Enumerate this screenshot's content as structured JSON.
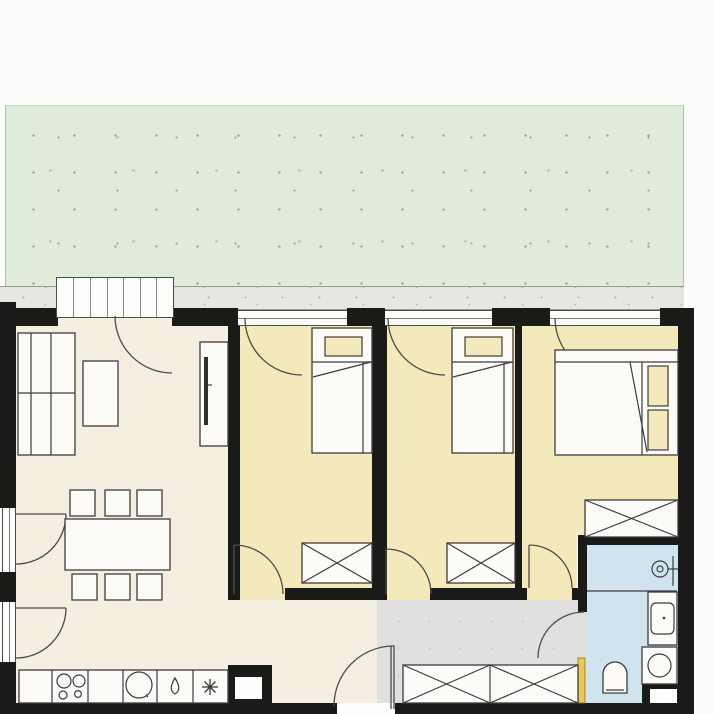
{
  "palette": {
    "outside": "#fcfcfb",
    "terrace": "#dfecda",
    "terrace_dot": "#8fa98a",
    "walk_strip": "#e7e7e2",
    "strip_dot": "#b5b5ad",
    "wall": "#1a1a18",
    "living": "#f5efe2",
    "bedroom": "#f3e9bb",
    "hall": "#e0e0de",
    "hall_dot": "#c6c6c2",
    "bathroom": "#cfe4ef",
    "furniture_fill": "#fcfbf7",
    "furniture_stroke": "#3c3c3c",
    "window_frame": "#4a4a46",
    "door_leaf": "#e8c952",
    "tv": "#2f2f2f"
  },
  "rooms": [
    {
      "name": "terrace-garden",
      "fill": "terrace"
    },
    {
      "name": "terrace-walkway",
      "fill": "walk_strip"
    },
    {
      "name": "living-dining-kitchen",
      "fill": "living"
    },
    {
      "name": "bedroom-1",
      "fill": "bedroom"
    },
    {
      "name": "bedroom-2",
      "fill": "bedroom"
    },
    {
      "name": "bedroom-3",
      "fill": "bedroom"
    },
    {
      "name": "entrance-hall",
      "fill": "hall"
    },
    {
      "name": "bathroom",
      "fill": "bathroom"
    }
  ],
  "furniture": {
    "living": [
      "corner-sofa",
      "coffee-table",
      "tv-sideboard",
      "dining-table",
      "dining-chairs-x6"
    ],
    "kitchen": [
      "kitchen-counter",
      "cooktop-4-burner",
      "sink",
      "tap-symbol",
      "hob-asterisk-symbol"
    ],
    "bedroom1": [
      "single-bed",
      "wardrobe"
    ],
    "bedroom2": [
      "single-bed",
      "wardrobe"
    ],
    "bedroom3": [
      "double-bed",
      "wardrobe"
    ],
    "hall": [
      "closet-row",
      "entrance-door"
    ],
    "bathroom": [
      "shower",
      "washbasin",
      "washing-machine",
      "toilet"
    ]
  },
  "doors": [
    "balcony-door-living",
    "balcony-door-bedroom-1",
    "balcony-door-bedroom-2",
    "balcony-door-bedroom-3",
    "garden-door-1",
    "garden-door-2",
    "bedroom-1-door",
    "bedroom-2-door",
    "bedroom-3-door",
    "bathroom-door",
    "apartment-entrance-door"
  ]
}
